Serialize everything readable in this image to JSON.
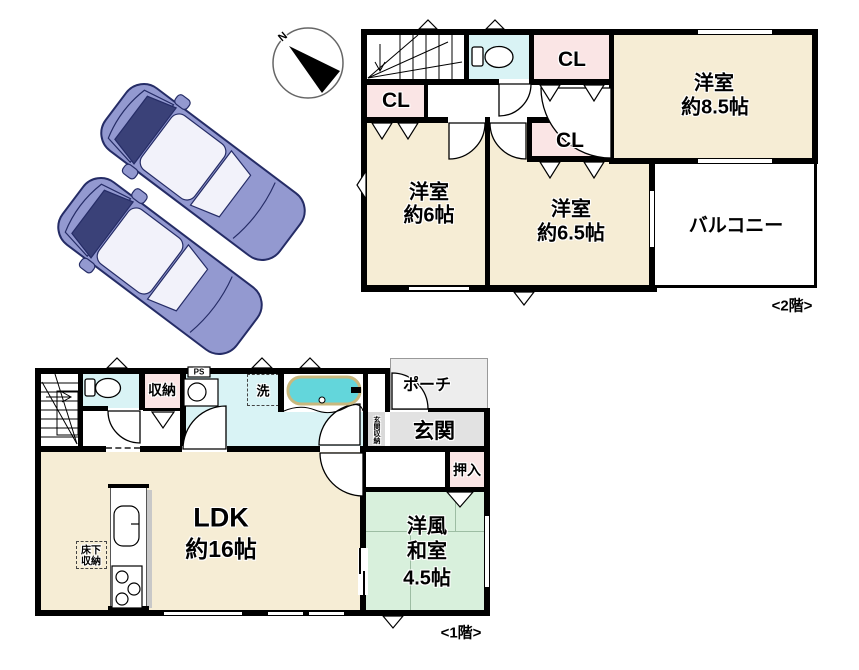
{
  "colors": {
    "room_cream": "#F6EDD5",
    "closet_pink": "#FAE5E5",
    "water_blue": "#D9F3F5",
    "tatami_green": "#D8F0DC",
    "entrance_gray": "#E2E2E2",
    "strip_gray": "#D9D9D9",
    "porch_gray": "#EDEDED",
    "tub_teal": "#63D6DB",
    "car_body": "#9399D0",
    "car_dark": "#252C66",
    "car_glass": "#3A4178",
    "car_light": "#F2F2FA",
    "wall_black": "#000000"
  },
  "compass": {
    "north_label": "N"
  },
  "floor2": {
    "floor_label": "<2階>",
    "rooms": {
      "bedroom_85": {
        "name": "洋室",
        "size": "約8.5帖"
      },
      "bedroom_6": {
        "name": "洋室",
        "size": "約6帖"
      },
      "bedroom_65": {
        "name": "洋室",
        "size": "約6.5帖"
      },
      "balcony": {
        "name": "バルコニー"
      },
      "closet_top": {
        "name": "CL"
      },
      "closet_left": {
        "name": "CL"
      },
      "closet_mid": {
        "name": "CL"
      }
    }
  },
  "floor1": {
    "floor_label": "<1階>",
    "rooms": {
      "ldk": {
        "name": "LDK",
        "size": "約16帖"
      },
      "japanese_room": {
        "name_line1": "洋風",
        "name_line2": "和室",
        "size": "4.5帖"
      },
      "entrance": {
        "name": "玄関"
      },
      "porch": {
        "name": "ポーチ"
      },
      "entrance_storage": {
        "name": "玄関収納"
      },
      "storage": {
        "name": "収納"
      },
      "oshiire": {
        "name": "押入"
      },
      "underfloor_storage": {
        "line1": "床下",
        "line2": "収納"
      },
      "pipe_space": {
        "name": "PS"
      },
      "laundry": {
        "name": "洗"
      }
    }
  }
}
